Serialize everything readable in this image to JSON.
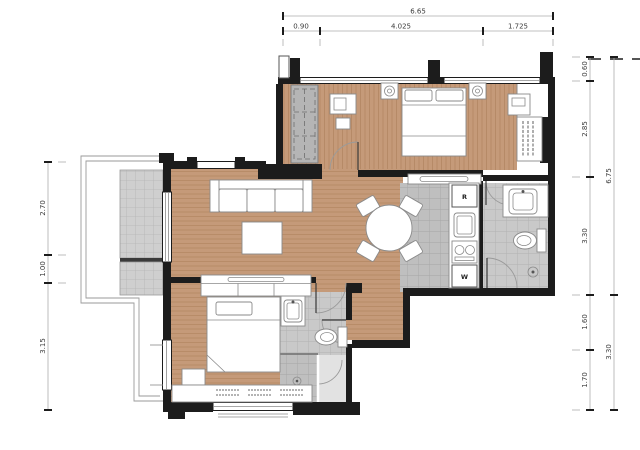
{
  "floorplan": {
    "dimensions": {
      "top_total": "6.65",
      "top_segments": [
        "0.90",
        "4.025",
        "1.725"
      ],
      "right_segments": [
        "0.60",
        "2.85",
        "3.30",
        "1.60",
        "1.70"
      ],
      "right_totals": [
        "6.75",
        "3.30"
      ],
      "left_segments": [
        "2.70",
        "1.00",
        "3.15"
      ]
    },
    "labels": {
      "refrigerator": "R",
      "washer": "W"
    },
    "colors": {
      "wood_floor": "#c59a79",
      "tile_floor": "#bfbfbf",
      "bath_tile": "#c8c8c8",
      "wall": "#1c1c1c",
      "background": "#ffffff"
    }
  }
}
